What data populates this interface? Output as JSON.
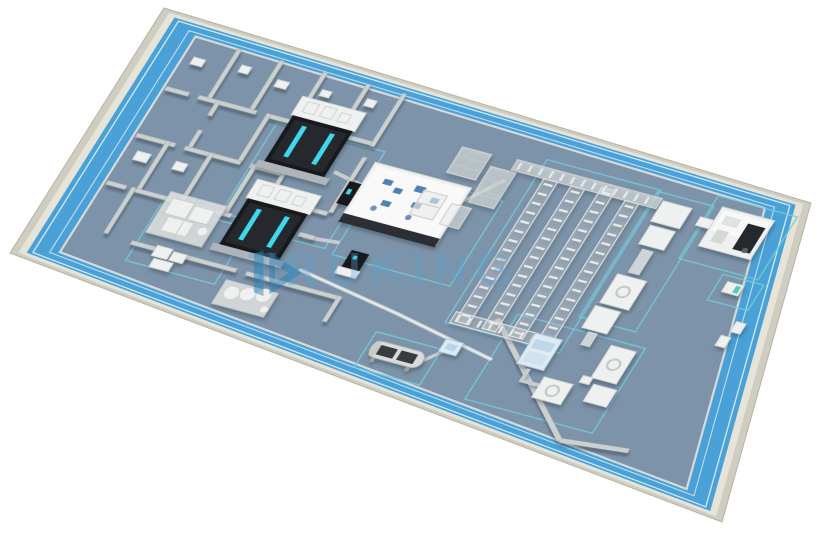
{
  "watermark": {
    "text": "TRUKING"
  },
  "colors": {
    "background": "#ffffff",
    "outer_wall": "#cfccc0",
    "outer_wall_top": "#e6e3d9",
    "walkway_blue": "#4aa1d7",
    "floor_blue_grey": "#7c93a9",
    "wall_grey": "#ccd0cf",
    "machine_white": "#eff1f0",
    "dark_machine": "#17191d",
    "accent_cyan": "#3fd9ee",
    "zone_teal": "#73ccd8",
    "watermark_blue": "#4a9fd0"
  },
  "scene": {
    "type": "isometric-pharma-factory-floor-plan",
    "elements": [
      "perimeter-wall",
      "walkway",
      "production-hall-floor",
      "cleanroom-suites",
      "freeze-dryer-1",
      "freeze-dryer-2",
      "compounding-skid",
      "storage-tanks",
      "filling-isolator",
      "buffer-towers",
      "overhead-gantry",
      "transfer-racks",
      "autoclave",
      "inspection-machine",
      "labelling-line",
      "cartoning-machine",
      "palletizing-robot",
      "floor-zone-markings"
    ]
  }
}
